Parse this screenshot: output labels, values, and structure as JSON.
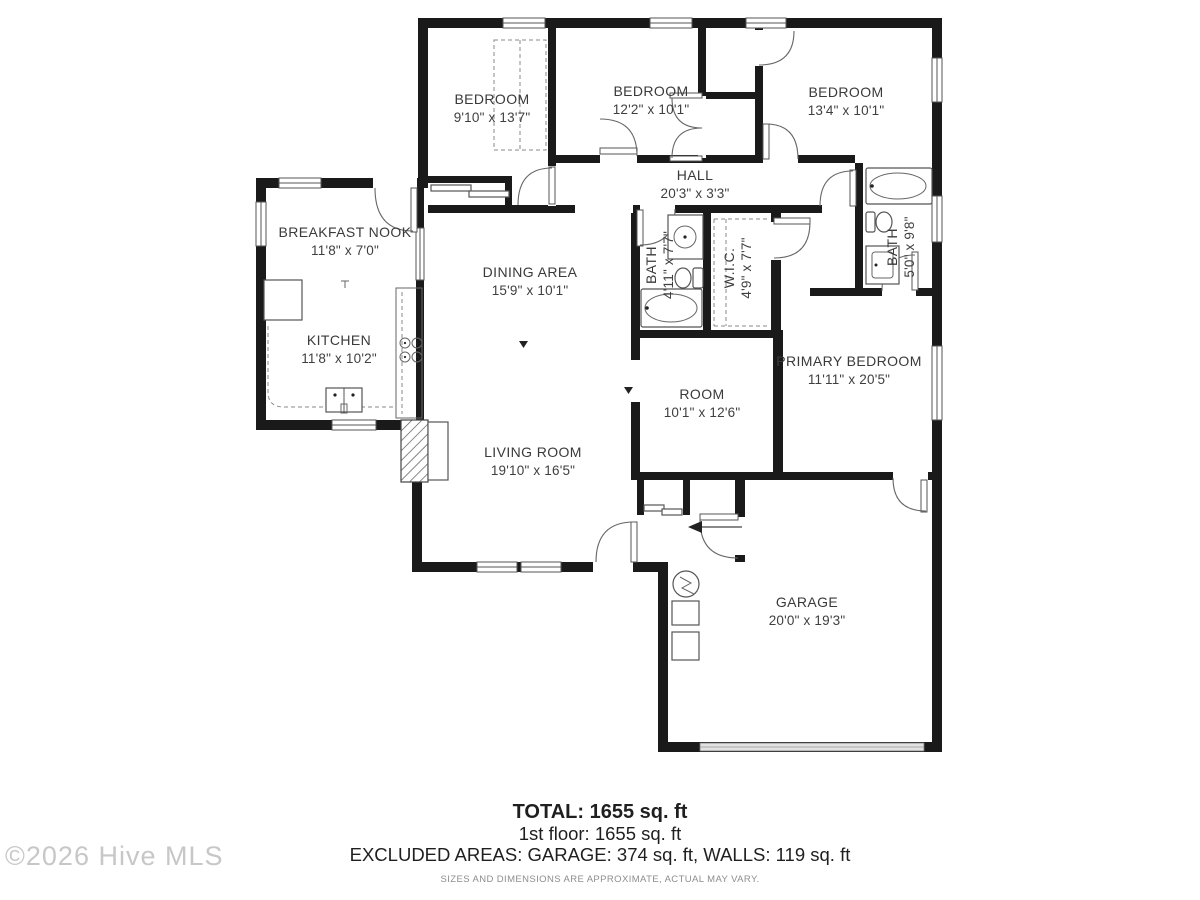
{
  "rooms": {
    "bedroom1": {
      "name": "BEDROOM",
      "dims": "9'10\" x 13'7\""
    },
    "bedroom2": {
      "name": "BEDROOM",
      "dims": "12'2\" x 10'1\""
    },
    "bedroom3": {
      "name": "BEDROOM",
      "dims": "13'4\" x 10'1\""
    },
    "hall": {
      "name": "HALL",
      "dims": "20'3\" x 3'3\""
    },
    "breakfast_nook": {
      "name": "BREAKFAST NOOK",
      "dims": "11'8\" x 7'0\""
    },
    "dining": {
      "name": "DINING AREA",
      "dims": "15'9\" x 10'1\""
    },
    "kitchen": {
      "name": "KITCHEN",
      "dims": "11'8\" x 10'2\""
    },
    "bath1": {
      "name": "BATH",
      "dims": "4'11\" x 7'7\""
    },
    "wic": {
      "name": "W.I.C.",
      "dims": "4'9\" x 7'7\""
    },
    "bath2": {
      "name": "BATH",
      "dims": "5'0\" x 9'8\""
    },
    "primary": {
      "name": "PRIMARY BEDROOM",
      "dims": "11'11\" x 20'5\""
    },
    "room": {
      "name": "ROOM",
      "dims": "10'1\" x 12'6\""
    },
    "living": {
      "name": "LIVING ROOM",
      "dims": "19'10\" x 16'5\""
    },
    "garage": {
      "name": "GARAGE",
      "dims": "20'0\" x 19'3\""
    }
  },
  "summary": {
    "total": "TOTAL: 1655 sq. ft",
    "floor": "1st floor: 1655 sq. ft",
    "excluded": "EXCLUDED AREAS: GARAGE: 374 sq. ft, WALLS: 119 sq. ft",
    "disclaimer": "SIZES AND DIMENSIONS ARE APPROXIMATE, ACTUAL MAY VARY."
  },
  "watermark": "©2026 Hive MLS",
  "colors": {
    "wall": "#1a1a1a",
    "label": "#3a3a3a",
    "watermark": "#c7c7c7",
    "garage_door": "#e2e2e2"
  }
}
